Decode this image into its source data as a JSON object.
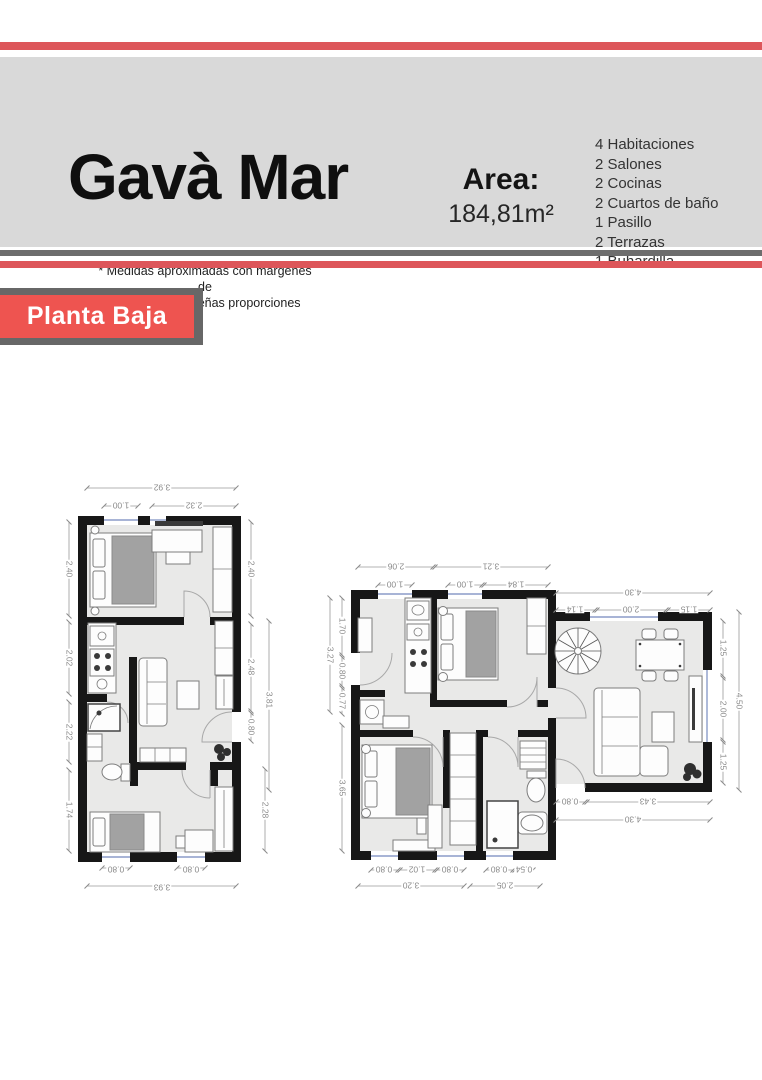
{
  "header": {
    "title": "Gavà Mar",
    "area_label": "Area:",
    "area_value": "184,81m²",
    "features": [
      "4 Habitaciones",
      "2 Salones",
      "2 Cocinas",
      "2 Cuartos de baño",
      "1 Pasillo",
      "2 Terrazas",
      "1 Buhardilla"
    ],
    "disclaimer_line1": "* Medidas aproximadas con margenes de",
    "disclaimer_line2": "errores en pequeñas proporciones"
  },
  "section": {
    "floor_label": "Planta Baja"
  },
  "colors": {
    "accent_red": "#dd565a",
    "badge_red": "#ee5450",
    "badge_gray": "#676767",
    "bar_gray": "#6d6d6d",
    "panel_gray": "#d9d9d9",
    "wall_black": "#171717",
    "floor_gray": "#e9e9e8",
    "dim_gray": "#8a8a8a"
  },
  "plan_left": {
    "dims": {
      "top_total": "3.92",
      "top_window": "1.00",
      "top_segment": "2.32",
      "left_bedroom": "2.40",
      "left_kitchen": "2.02",
      "left_bath": "2.22",
      "left_bedroom2": "1.74",
      "right_bedroom": "2.40",
      "right_closet": "2.48",
      "right_living": "3.81",
      "right_door": "0.80",
      "right_bedroom2": "2.28",
      "bottom_window1": "0.80",
      "bottom_window2": "0.80",
      "bottom_total": "3.93"
    }
  },
  "plan_right": {
    "dims": {
      "top_kitchen": "2.06",
      "top_bedroom": "3.21",
      "top_window1": "1.00",
      "top_window2": "1.00",
      "top_segment": "1.84",
      "top_living_total": "4.30",
      "top_living_seg1": "1.14",
      "top_living_window": "2.00",
      "top_living_seg2": "1.15",
      "left_outer": "3.27",
      "left_kitchen": "1.70",
      "left_door": "0.80",
      "left_hall": "0.77",
      "left_bedroom": "3.65",
      "right_seg1": "1.25",
      "right_window": "2.00",
      "right_seg2": "1.25",
      "right_total": "4.50",
      "bottom_living_door": "0.80",
      "bottom_living_seg": "3.43",
      "bottom_living_total": "4.30",
      "bottom_window1": "0.80",
      "bottom_seg1": "1.02",
      "bottom_window2": "0.80",
      "bottom_total1": "3.20",
      "bottom_window3": "0.80",
      "bottom_seg2": "0.54",
      "bottom_total2": "2.05"
    }
  }
}
